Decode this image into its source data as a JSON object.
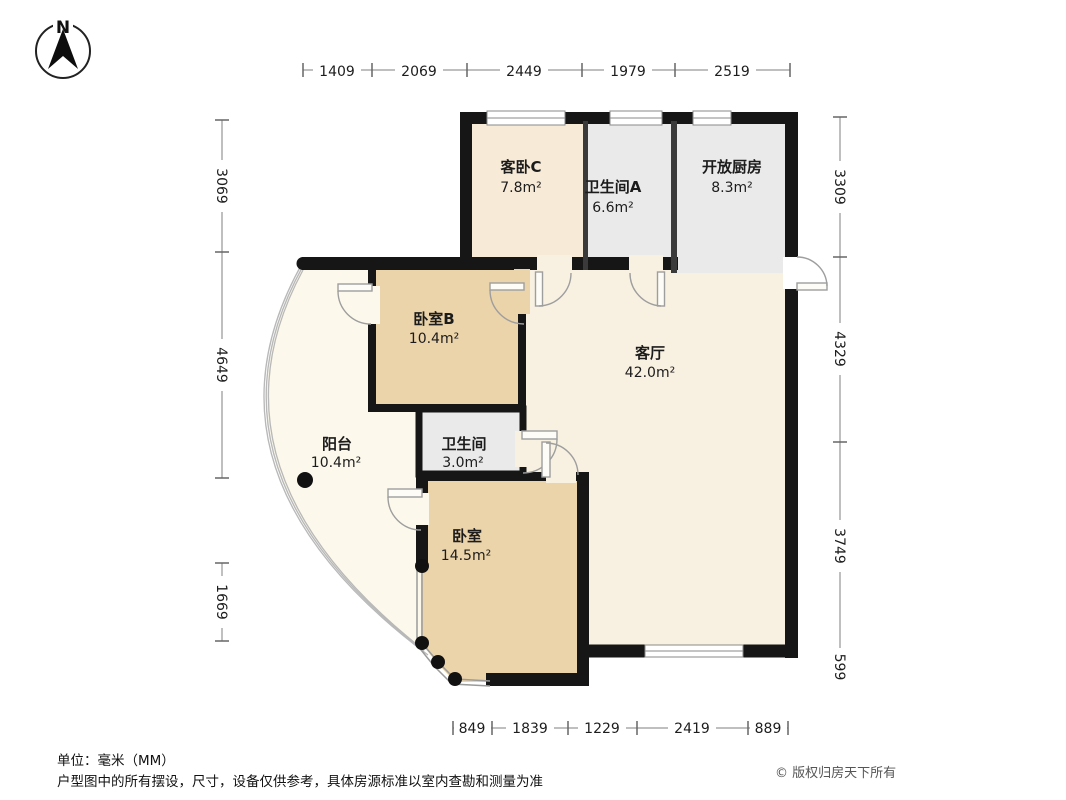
{
  "compass": {
    "label": "N"
  },
  "rooms": [
    {
      "name": "客卧C",
      "area": "7.8m²"
    },
    {
      "name": "卫生间A",
      "area": "6.6m²"
    },
    {
      "name": "开放厨房",
      "area": "8.3m²"
    },
    {
      "name": "卧室B",
      "area": "10.4m²"
    },
    {
      "name": "客厅",
      "area": "42.0m²"
    },
    {
      "name": "阳台",
      "area": "10.4m²"
    },
    {
      "name": "卫生间",
      "area": "3.0m²"
    },
    {
      "name": "卧室",
      "area": "14.5m²"
    }
  ],
  "dimensions": {
    "top": [
      "1409",
      "2069",
      "2449",
      "1979",
      "2519"
    ],
    "bottom": [
      "849",
      "1839",
      "1229",
      "2419",
      "889"
    ],
    "left": [
      "3069",
      "4649",
      "1669"
    ],
    "right": [
      "3309",
      "4329",
      "3749",
      "599"
    ]
  },
  "footer": {
    "unit": "单位：毫米（MM）",
    "disclaimer": "户型图中的所有摆设，尺寸，设备仅供参考，具体房源标准以室内查勘和测量为准",
    "copyright": "© 版权归房天下所有"
  },
  "colors": {
    "wall": "#161616",
    "living_fill": "#f8f1e2",
    "bedroom_fill": "#ebd3aa",
    "guest_fill": "#f7ead7",
    "bath_fill": "#eaeaea",
    "balcony_fill": "#fcf9ec"
  }
}
